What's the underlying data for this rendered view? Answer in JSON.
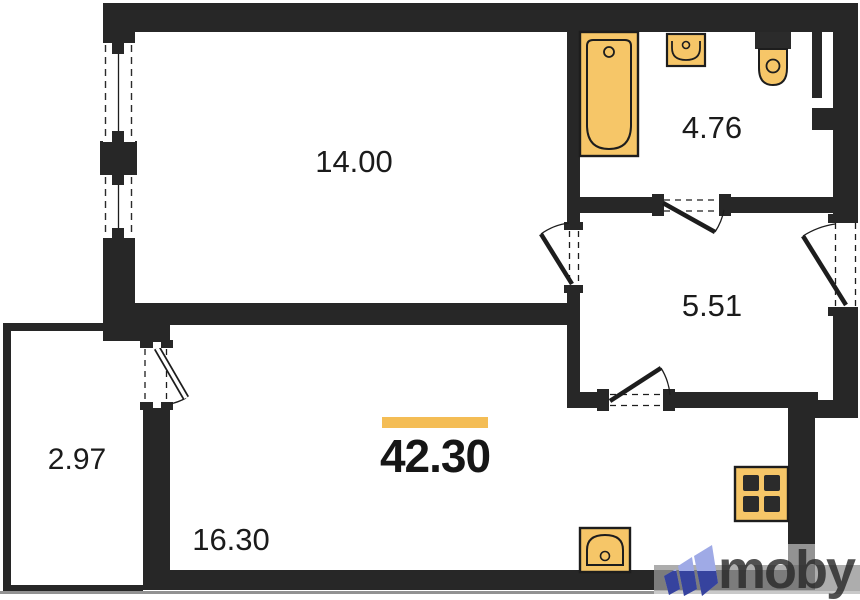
{
  "plan": {
    "total": {
      "area": "42.30"
    },
    "rooms": [
      {
        "name": "room",
        "area": "14.00"
      },
      {
        "name": "bathroom",
        "area": "4.76"
      },
      {
        "name": "hallway",
        "area": "5.51"
      },
      {
        "name": "balcony",
        "area": "2.97"
      },
      {
        "name": "living-kitchen",
        "area": "16.30"
      }
    ],
    "fixtures": [
      "bathtub-icon",
      "bath-sink-icon",
      "toilet-icon",
      "stove-icon",
      "kitchen-sink-icon"
    ],
    "colors": {
      "wall": "#272727",
      "fixture_fill": "#F6C668",
      "fixture_line": "#1d1d1d",
      "accent_bar": "#F4BD55"
    }
  },
  "watermark": {
    "brand": "moby",
    "logo_colors": {
      "light": "#9FAAE6",
      "dark": "#36439E"
    }
  }
}
